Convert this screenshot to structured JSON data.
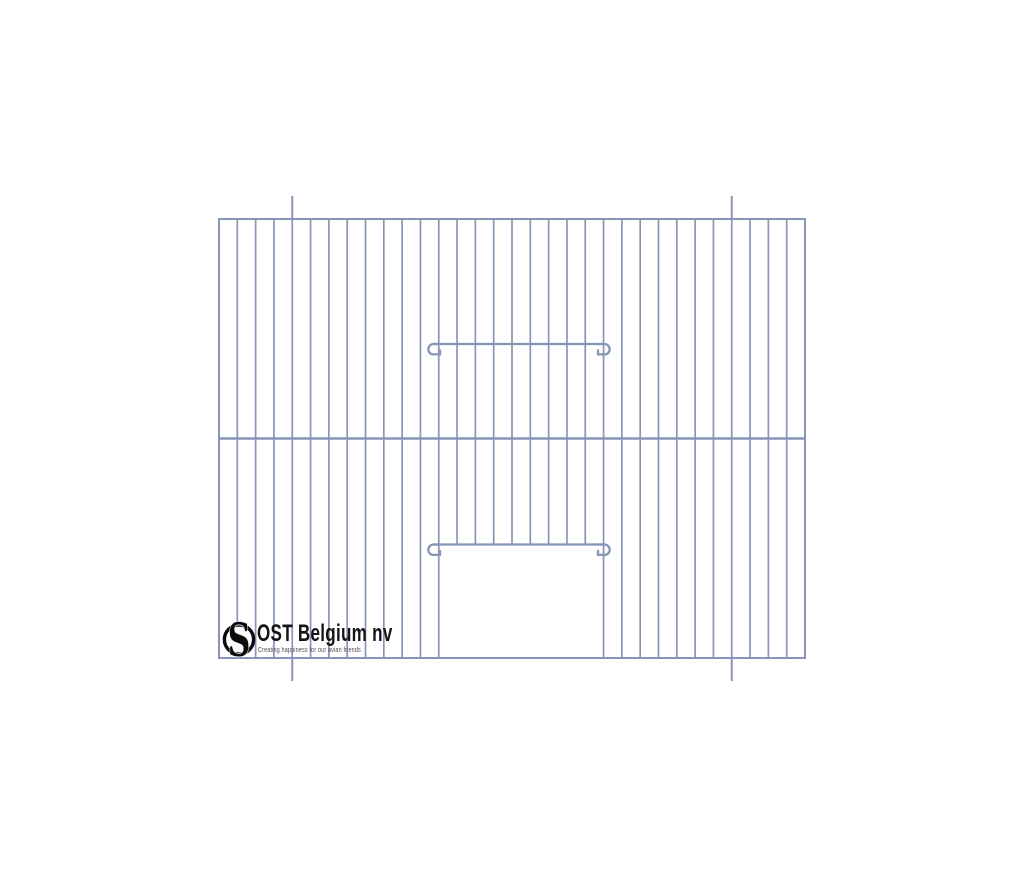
{
  "logo": {
    "name": "OST Belgium nv",
    "tagline": "Creating happiness for our avian friends",
    "mark_letter": "S",
    "mark_color": "#0b0b0b"
  },
  "drawing": {
    "description": "Front wire panel of a bird cage with vertical wires, a middle crossbar, two sliding-door wires with end hooks, an open door cut-out at bottom center, and two hanging wires extending past the top and bottom edges",
    "background": "#ffffff",
    "wire_color": "#8695b8",
    "panel": {
      "left": 219,
      "top": 219,
      "right": 805,
      "bottom": 658
    },
    "vertical_wire_count": 33,
    "wire_spacing": 18.3125,
    "middle_bar_y": 438.5,
    "door": {
      "open_wire_start": 13,
      "open_wire_end": 20
    },
    "sliders": [
      {
        "y": 344
      },
      {
        "y": 544.5
      }
    ],
    "slider_x1": 433.5,
    "slider_x2": 604.5,
    "hook_radius": 5.2,
    "hanging_wires": {
      "xs": [
        292.25,
        731.75
      ],
      "top_extend": 23,
      "bottom_extend": 23
    }
  }
}
